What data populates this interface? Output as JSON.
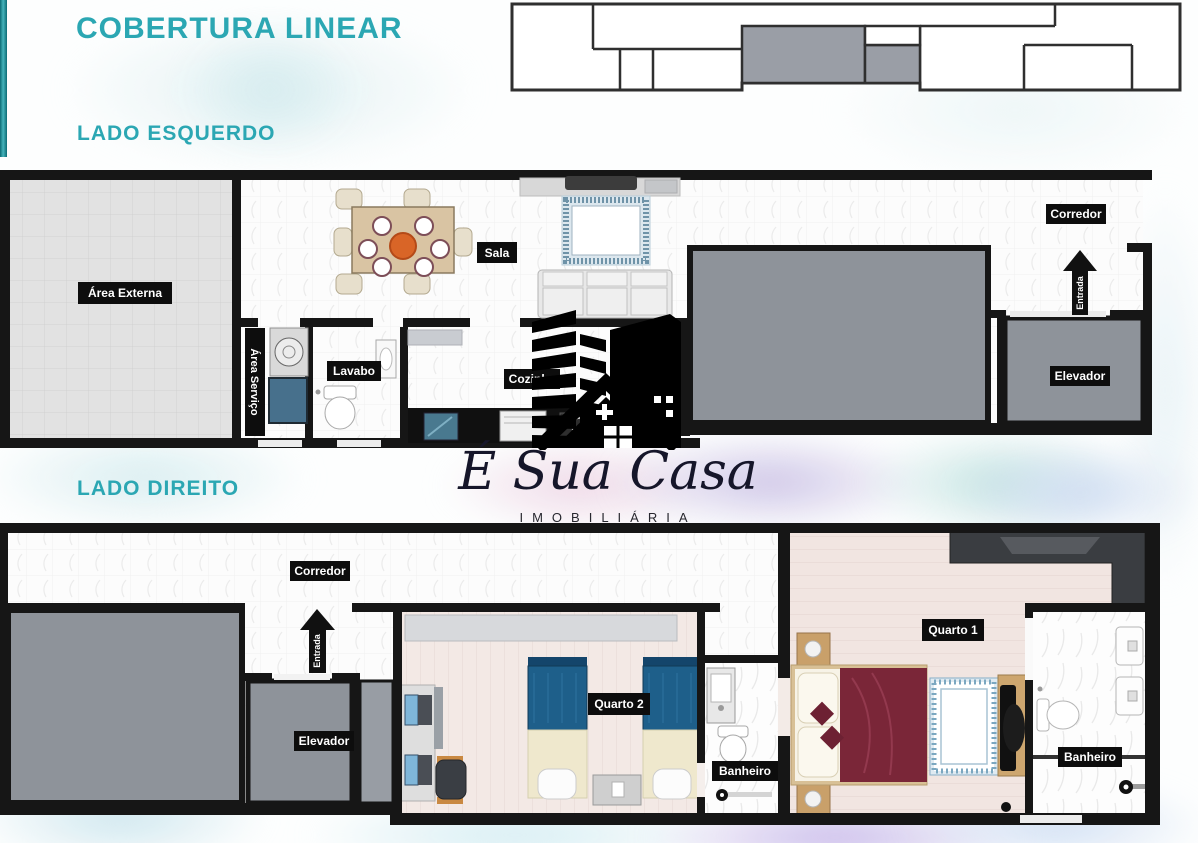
{
  "page": {
    "title": "COBERTURA LINEAR",
    "section_left": "LADO ESQUERDO",
    "section_right": "LADO DIREITO"
  },
  "logo": {
    "name": "É Sua Casa",
    "subtitle": "IMOBILIÁRIA"
  },
  "plan_left": {
    "labels": {
      "area_externa": "Área Externa",
      "sala": "Sala",
      "corredor": "Corredor",
      "entrada": "Entrada",
      "elevador": "Elevador",
      "area_servico": "Área Serviço",
      "lavabo": "Lavabo",
      "cozinha": "Cozinha"
    }
  },
  "plan_right": {
    "labels": {
      "corredor": "Corredor",
      "entrada": "Entrada",
      "elevador": "Elevador",
      "quarto2": "Quarto 2",
      "banheiro_quarto2": "Banheiro",
      "quarto1": "Quarto 1",
      "banheiro_quarto1": "Banheiro"
    }
  },
  "colors": {
    "accent_teal": "#2ba7b3",
    "wall_black": "#161616",
    "block_gray": "#8e939a",
    "label_bg": "#0d0d0d",
    "label_text": "#ffffff"
  }
}
